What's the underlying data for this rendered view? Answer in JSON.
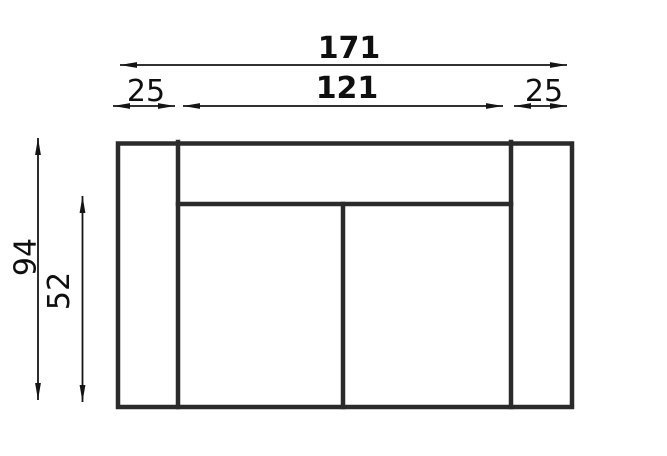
{
  "diagram": {
    "background_color": "#ffffff",
    "outline_color": "#2b2b2b",
    "dimension_color": "#141414",
    "text_color": "#0f0f0f",
    "dimensions": {
      "total_width": "171",
      "inner_width": "121",
      "left_arm_width": "25",
      "right_arm_width": "25",
      "total_depth": "94",
      "seat_depth": "52"
    }
  }
}
